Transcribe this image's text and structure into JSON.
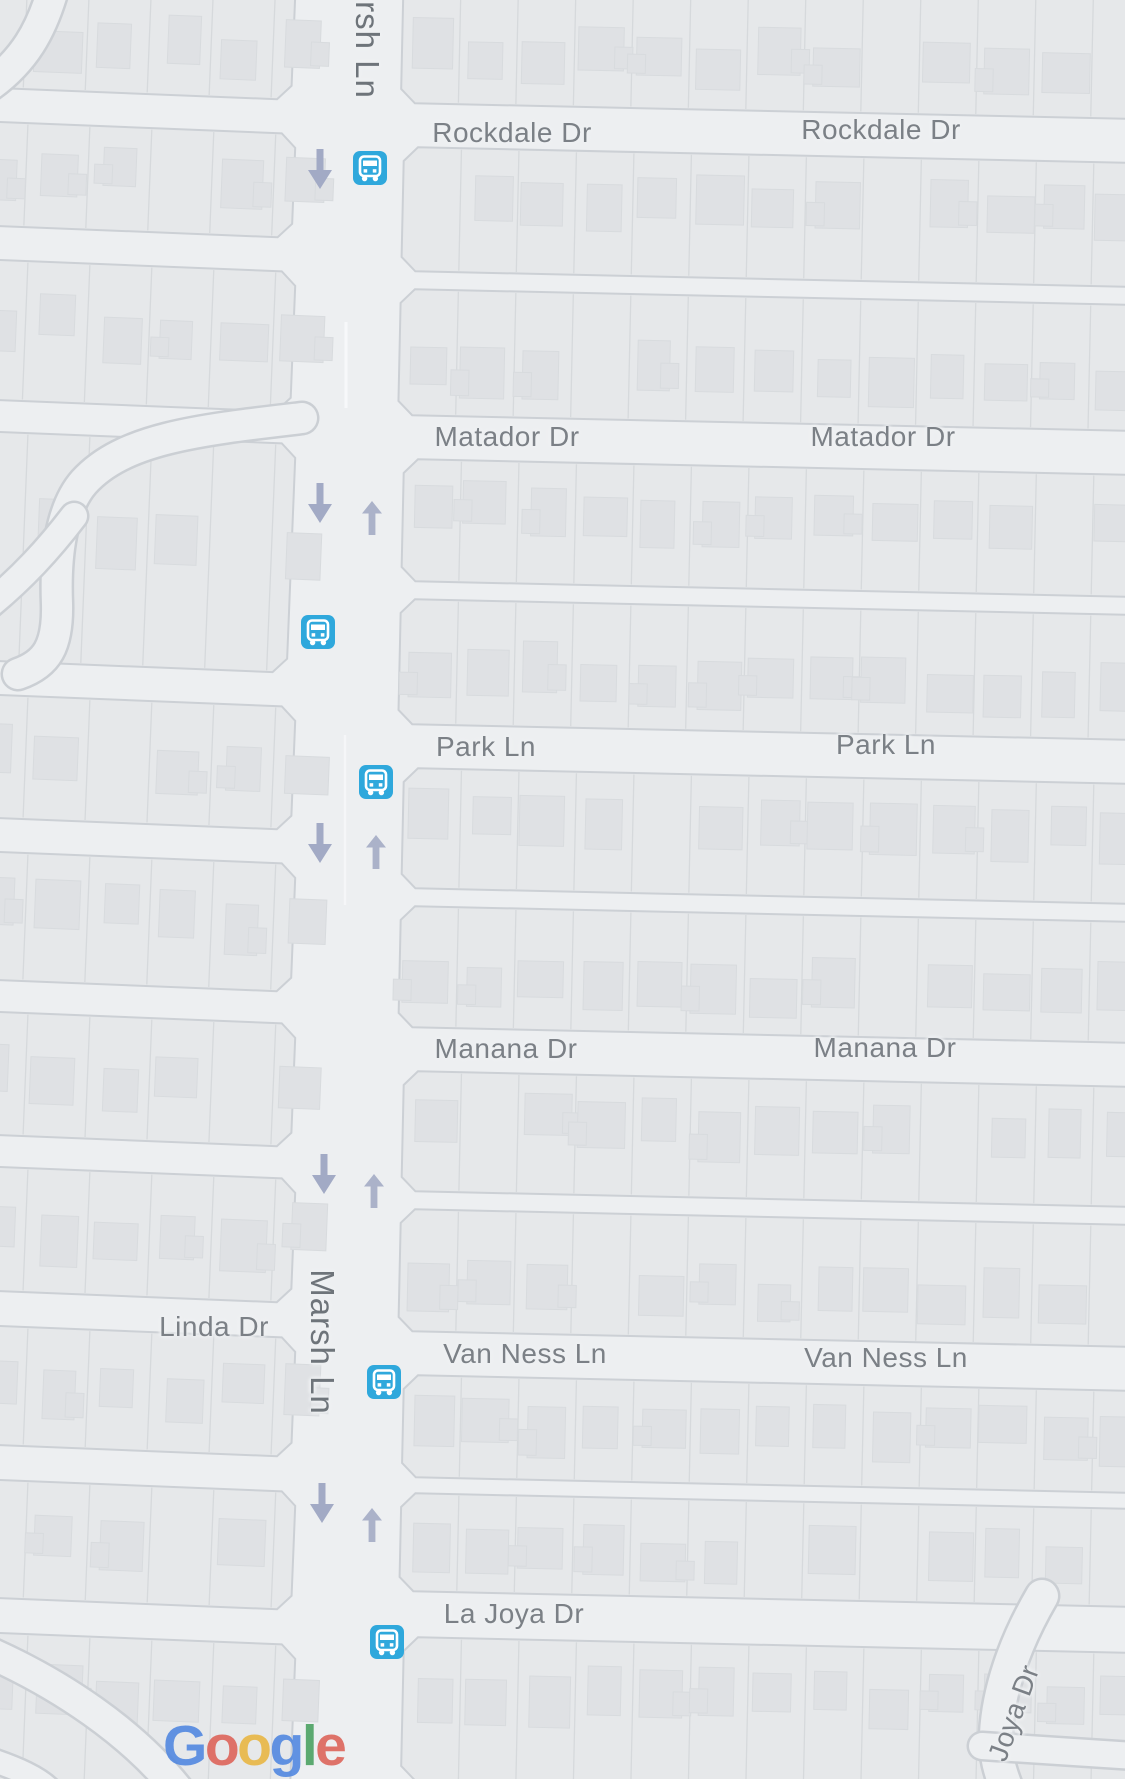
{
  "map": {
    "street_labels": [
      {
        "id": "marsh-ln-top",
        "text": "rsh Ln"
      },
      {
        "id": "rockdale-dr-west",
        "text": "Rockdale Dr"
      },
      {
        "id": "rockdale-dr-east",
        "text": "Rockdale Dr"
      },
      {
        "id": "matador-dr-west",
        "text": "Matador Dr"
      },
      {
        "id": "matador-dr-east",
        "text": "Matador Dr"
      },
      {
        "id": "park-ln-west",
        "text": "Park Ln"
      },
      {
        "id": "park-ln-east",
        "text": "Park Ln"
      },
      {
        "id": "manana-dr-west",
        "text": "Manana Dr"
      },
      {
        "id": "manana-dr-east",
        "text": "Manana Dr"
      },
      {
        "id": "linda-dr",
        "text": "Linda Dr"
      },
      {
        "id": "marsh-ln",
        "text": "Marsh Ln"
      },
      {
        "id": "van-ness-ln-west",
        "text": "Van Ness Ln"
      },
      {
        "id": "van-ness-ln-east",
        "text": "Van Ness Ln"
      },
      {
        "id": "la-joya-dr",
        "text": "La Joya Dr"
      },
      {
        "id": "joya-dr",
        "text": "Joya Dr"
      }
    ],
    "transit_stops": [
      {
        "icon": "bus-stop-icon"
      },
      {
        "icon": "bus-stop-icon"
      },
      {
        "icon": "bus-stop-icon"
      },
      {
        "icon": "bus-stop-icon"
      },
      {
        "icon": "bus-stop-icon"
      }
    ],
    "direction_arrows": {
      "southbound": 5,
      "northbound": 4
    },
    "attribution": {
      "logo_text": "Google",
      "letters": [
        {
          "ch": "G",
          "color": "#4e86e0"
        },
        {
          "ch": "o",
          "color": "#dd6157"
        },
        {
          "ch": "o",
          "color": "#e9b540"
        },
        {
          "ch": "g",
          "color": "#4e86e0"
        },
        {
          "ch": "l",
          "color": "#47a05f"
        },
        {
          "ch": "e",
          "color": "#dd6157"
        }
      ]
    },
    "colors": {
      "bus_stop": "#2fa8dc",
      "arrow_south": "#a2aac5",
      "arrow_north": "#abb2c9",
      "label": "#7b8086",
      "label_dark": "#6e747a",
      "street": "#edeff1",
      "block": "#e6e8ea",
      "building": "#dfe1e4"
    }
  }
}
